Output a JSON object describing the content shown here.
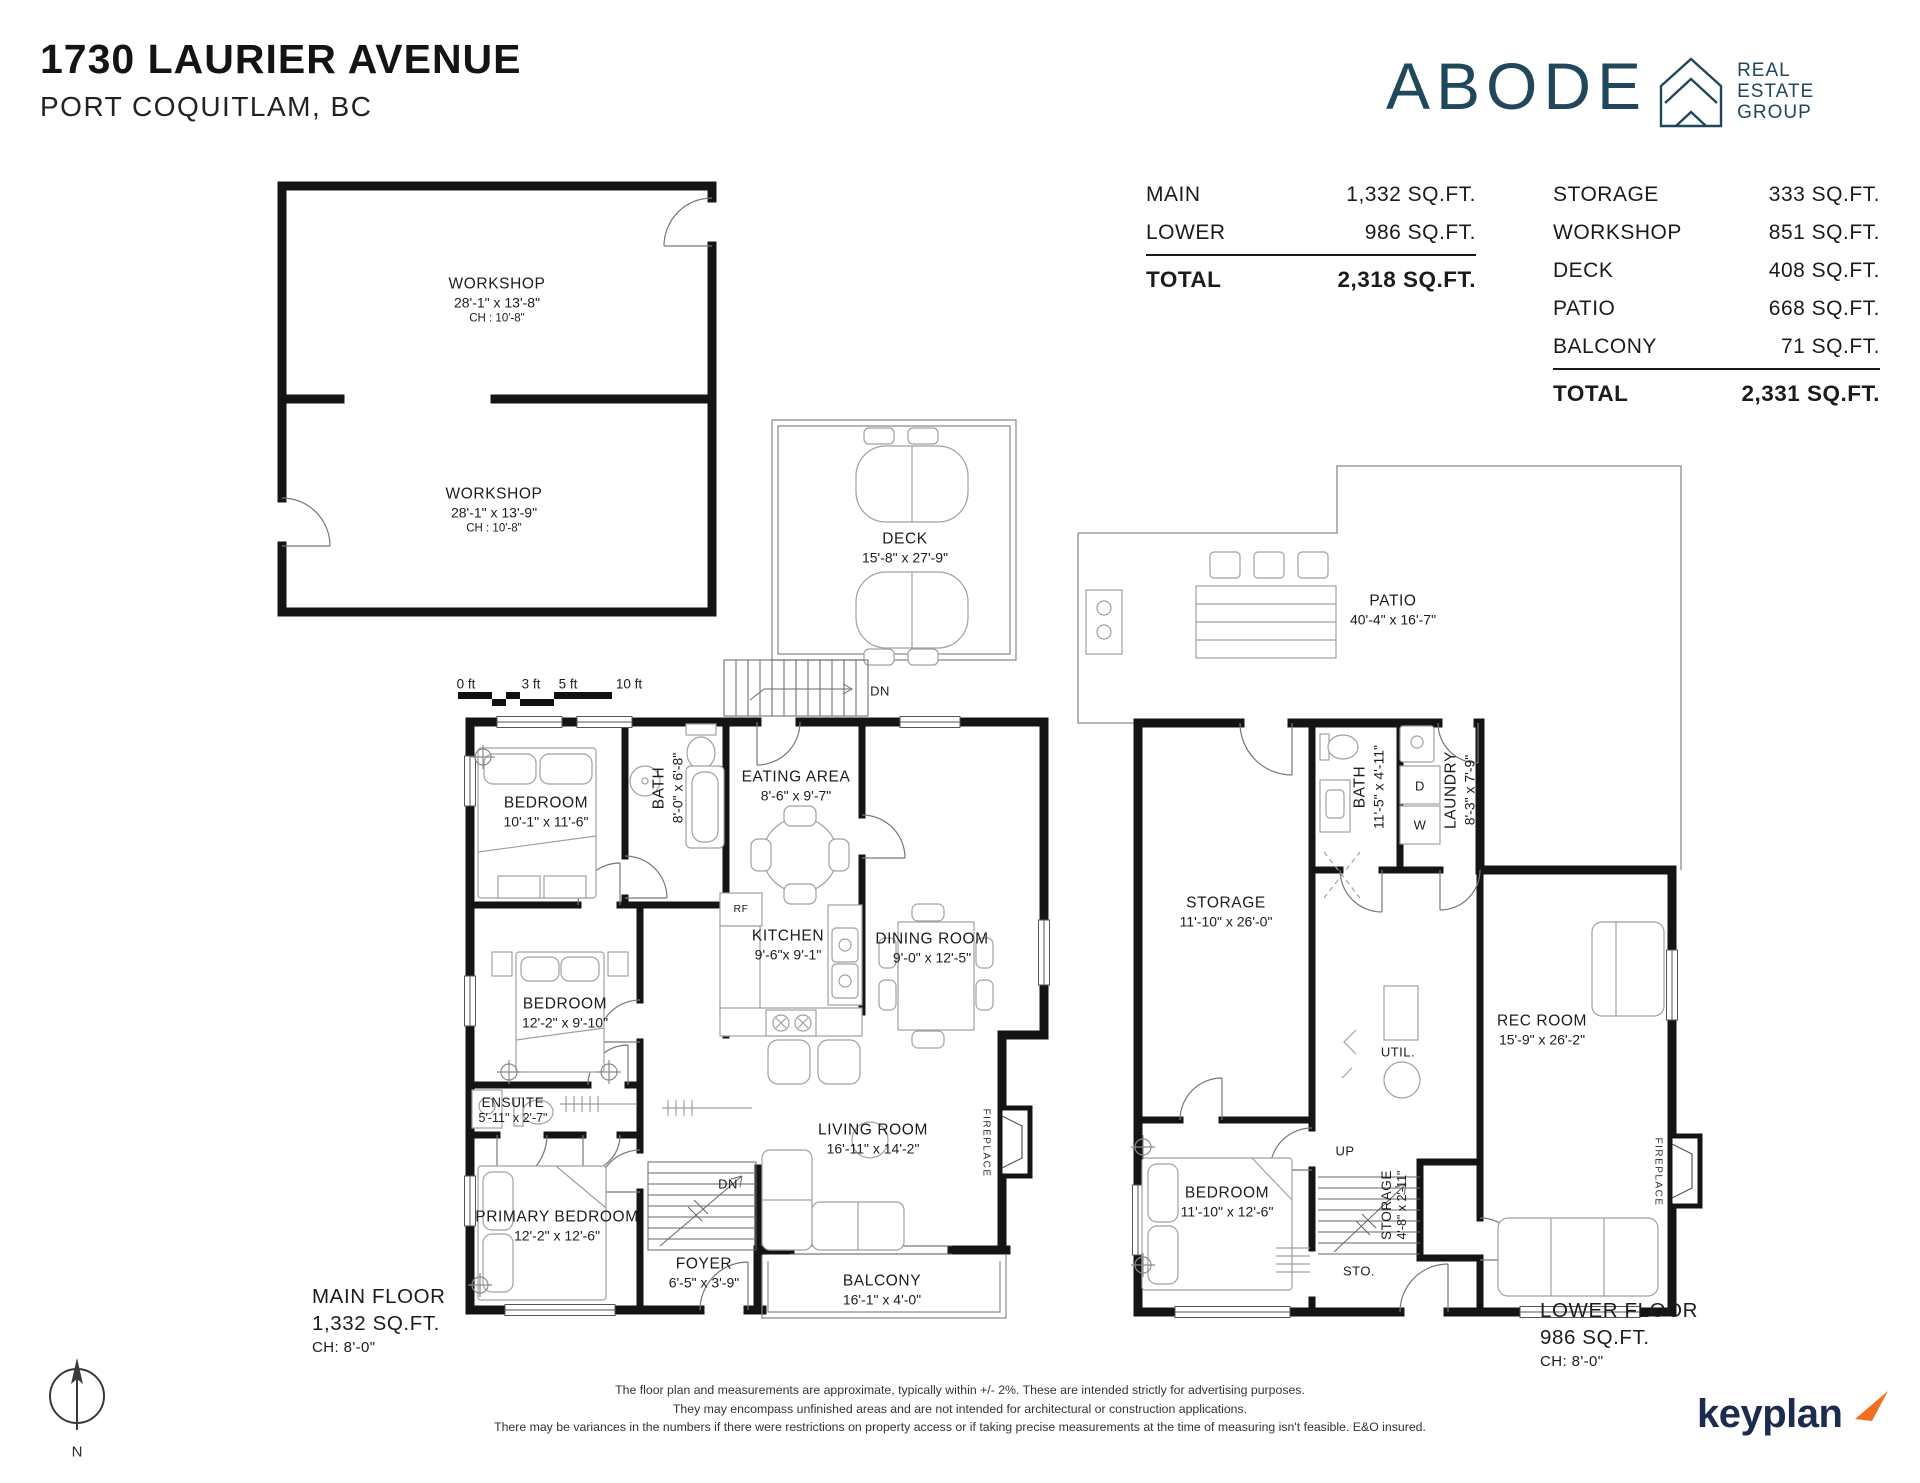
{
  "header": {
    "address": "1730 LAURIER AVENUE",
    "city": "PORT COQUITLAM, BC"
  },
  "brand": {
    "name": "ABODE",
    "tagline": [
      "REAL",
      "ESTATE",
      "GROUP"
    ]
  },
  "summary": {
    "floors": {
      "rows": [
        {
          "label": "MAIN",
          "value": "1,332 SQ.FT."
        },
        {
          "label": "LOWER",
          "value": "986 SQ.FT."
        }
      ],
      "total_label": "TOTAL",
      "total_value": "2,318 SQ.FT."
    },
    "extras": {
      "rows": [
        {
          "label": "STORAGE",
          "value": "333 SQ.FT."
        },
        {
          "label": "WORKSHOP",
          "value": "851 SQ.FT."
        },
        {
          "label": "DECK",
          "value": "408 SQ.FT."
        },
        {
          "label": "PATIO",
          "value": "668 SQ.FT."
        },
        {
          "label": "BALCONY",
          "value": "71 SQ.FT."
        }
      ],
      "total_label": "TOTAL",
      "total_value": "2,331 SQ.FT."
    }
  },
  "scale_bar": {
    "ticks": [
      "0 ft",
      "3 ft",
      "5 ft",
      "10 ft"
    ]
  },
  "rooms": {
    "workshop1": {
      "name": "WORKSHOP",
      "dims": "28'-1\" x 13'-8\"",
      "ch": "CH : 10'-8\""
    },
    "workshop2": {
      "name": "WORKSHOP",
      "dims": "28'-1\" x 13'-9\"",
      "ch": "CH : 10'-8\""
    },
    "deck": {
      "name": "DECK",
      "dims": "15'-8\" x 27'-9\""
    },
    "patio": {
      "name": "PATIO",
      "dims": "40'-4\" x 16'-7\""
    },
    "bedroom1": {
      "name": "BEDROOM",
      "dims": "10'-1\" x 11'-6\""
    },
    "bath_main": {
      "name": "BATH",
      "dims": "8'-0\" x 6'-8\""
    },
    "eating_area": {
      "name": "EATING AREA",
      "dims": "8'-6\" x 9'-7\""
    },
    "kitchen": {
      "name": "KITCHEN",
      "dims": "9'-6\"x 9'-1\""
    },
    "dining_room": {
      "name": "DINING ROOM",
      "dims": "9'-0\" x 12'-5\""
    },
    "bedroom2": {
      "name": "BEDROOM",
      "dims": "12'-2\" x 9'-10\""
    },
    "ensuite": {
      "name": "ENSUITE",
      "dims": "5'-11\" x 2'-7\""
    },
    "primary_bedroom": {
      "name": "PRIMARY BEDROOM",
      "dims": "12'-2\" x 12'-6\""
    },
    "foyer": {
      "name": "FOYER",
      "dims": "6'-5\" x 3'-9\""
    },
    "living_room": {
      "name": "LIVING ROOM",
      "dims": "16'-11\" x 14'-2\""
    },
    "balcony": {
      "name": "BALCONY",
      "dims": "16'-1\" x 4'-0\""
    },
    "storage_lower": {
      "name": "STORAGE",
      "dims": "11'-10\" x 26'-0\""
    },
    "bath_lower": {
      "name": "BATH",
      "dims": "11'-5\" x 4'-11\""
    },
    "laundry": {
      "name": "LAUNDRY",
      "dims": "8'-3\" x 7'-9\""
    },
    "rec_room": {
      "name": "REC ROOM",
      "dims": "15'-9\" x 26'-2\""
    },
    "bedroom_lower": {
      "name": "BEDROOM",
      "dims": "11'-10\" x 12'-6\""
    },
    "storage_closet": {
      "name": "STORAGE",
      "dims": "4'-8\" x 2'-11\""
    }
  },
  "annotations": {
    "dn": "DN",
    "up": "UP",
    "sto": "STO.",
    "util": "UTIL.",
    "rf": "RF",
    "dryer": "D",
    "washer": "W",
    "fireplace": "FIREPLACE",
    "north": "N"
  },
  "floor_titles": {
    "main": {
      "title": "MAIN FLOOR",
      "area": "1,332 SQ.FT.",
      "ch": "CH: 8'-0\""
    },
    "lower": {
      "title": "LOWER FLOOR",
      "area": "986 SQ.FT.",
      "ch": "CH: 8'-0\""
    }
  },
  "footer": {
    "disclaimer": [
      "The floor plan and measurements are approximate, typically within +/- 2%. These are intended strictly for advertising purposes.",
      "They may encompass unfinished areas and are not intended for architectural or construction applications.",
      "There may be variances in the numbers if there were restrictions on property access or if taking precise measurements at the time of measuring isn't feasible. E&O insured."
    ],
    "logo": "keyplan"
  },
  "colors": {
    "brand_navy": "#20475a",
    "keyplan_navy": "#1d2c4e",
    "keyplan_orange": "#f26f21",
    "wall": "#141414"
  }
}
